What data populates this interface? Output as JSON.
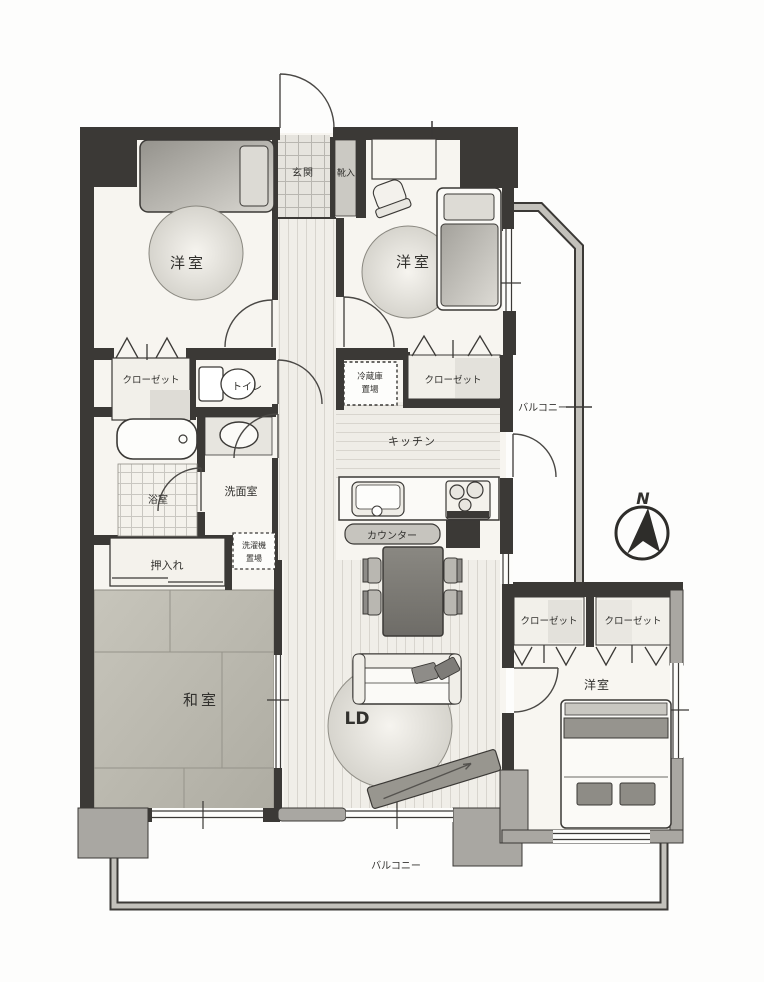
{
  "compass": {
    "north_label": "N"
  },
  "labels": {
    "entrance": "玄関",
    "shoe_cabinet": "靴入",
    "bedroom_nw": "洋室",
    "bedroom_ne": "洋室",
    "closet_west": "クローゼット",
    "toilet": "トイレ",
    "fridge_space_line1": "冷蔵庫",
    "fridge_space_line2": "置場",
    "closet_north": "クローゼット",
    "balcony_east": "バルコニー",
    "kitchen": "キッチン",
    "bathroom": "浴室",
    "washroom": "洗面室",
    "laundry_space_line1": "洗濯機",
    "laundry_space_line2": "置場",
    "counter": "カウンター",
    "oshiire": "押入れ",
    "japanese_room": "和室",
    "living_dining": "LD",
    "closet_se_left": "クローゼット",
    "closet_se_right": "クローゼット",
    "bedroom_se": "洋室",
    "balcony_south": "バルコニー"
  },
  "colors": {
    "wall": "#3b3936",
    "floor": "#f7f5f0",
    "tatami": "#bdbbb1",
    "gray_fill": "#a9a7a2",
    "balcony_band": "#c3c1bb",
    "text": "#32312e"
  }
}
